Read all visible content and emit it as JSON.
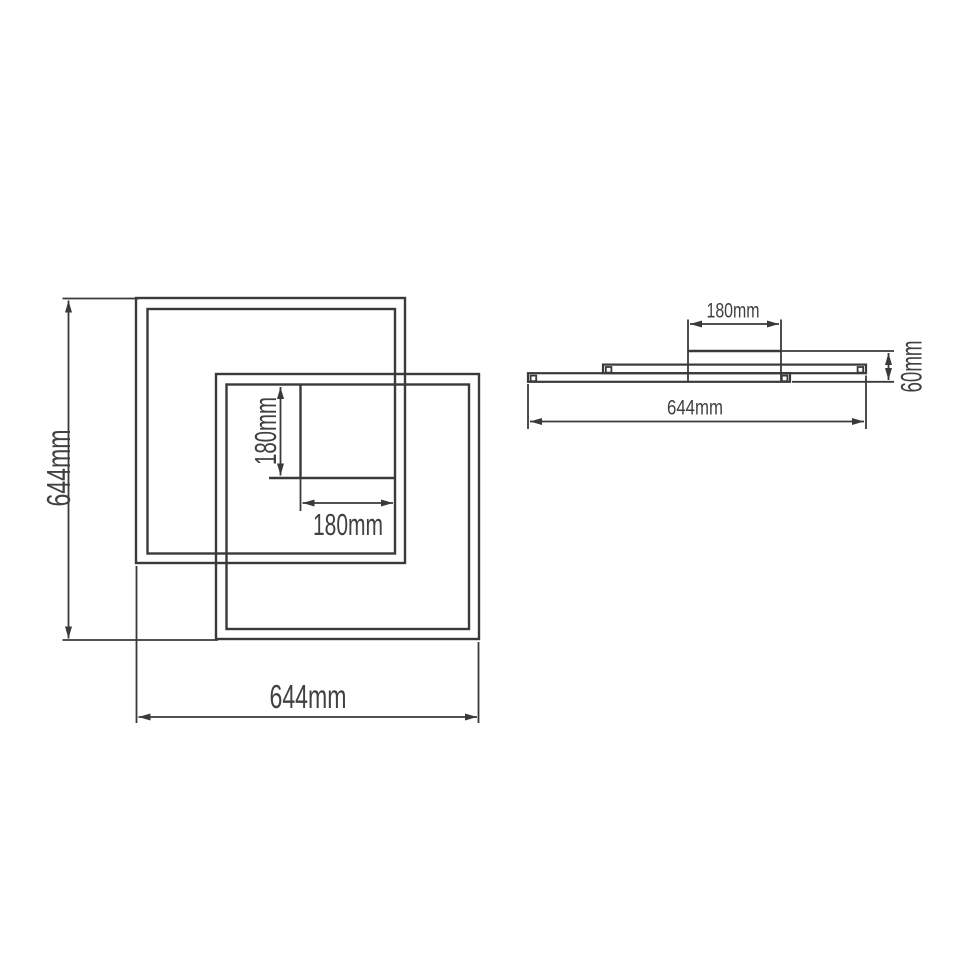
{
  "page": {
    "background": "#ffffff"
  },
  "drawing": {
    "type": "technical-dimension-drawing",
    "subject": "ceiling-lamp-two-overlapping-square-frames",
    "line_color": "#3a3a3a",
    "text_color": "#414141",
    "views": {
      "front": {
        "overall_height": {
          "value": 644,
          "unit": "mm",
          "label": "644mm"
        },
        "overall_width": {
          "value": 644,
          "unit": "mm",
          "label": "644mm"
        },
        "canopy_height": {
          "value": 180,
          "unit": "mm",
          "label": "180mm"
        },
        "canopy_width": {
          "value": 180,
          "unit": "mm",
          "label": "180mm"
        }
      },
      "side": {
        "canopy_width": {
          "value": 180,
          "unit": "mm",
          "label": "180mm"
        },
        "fixture_height": {
          "value": 60,
          "unit": "mm",
          "label": "60mm"
        },
        "overall_width": {
          "value": 644,
          "unit": "mm",
          "label": "644mm"
        }
      }
    }
  }
}
